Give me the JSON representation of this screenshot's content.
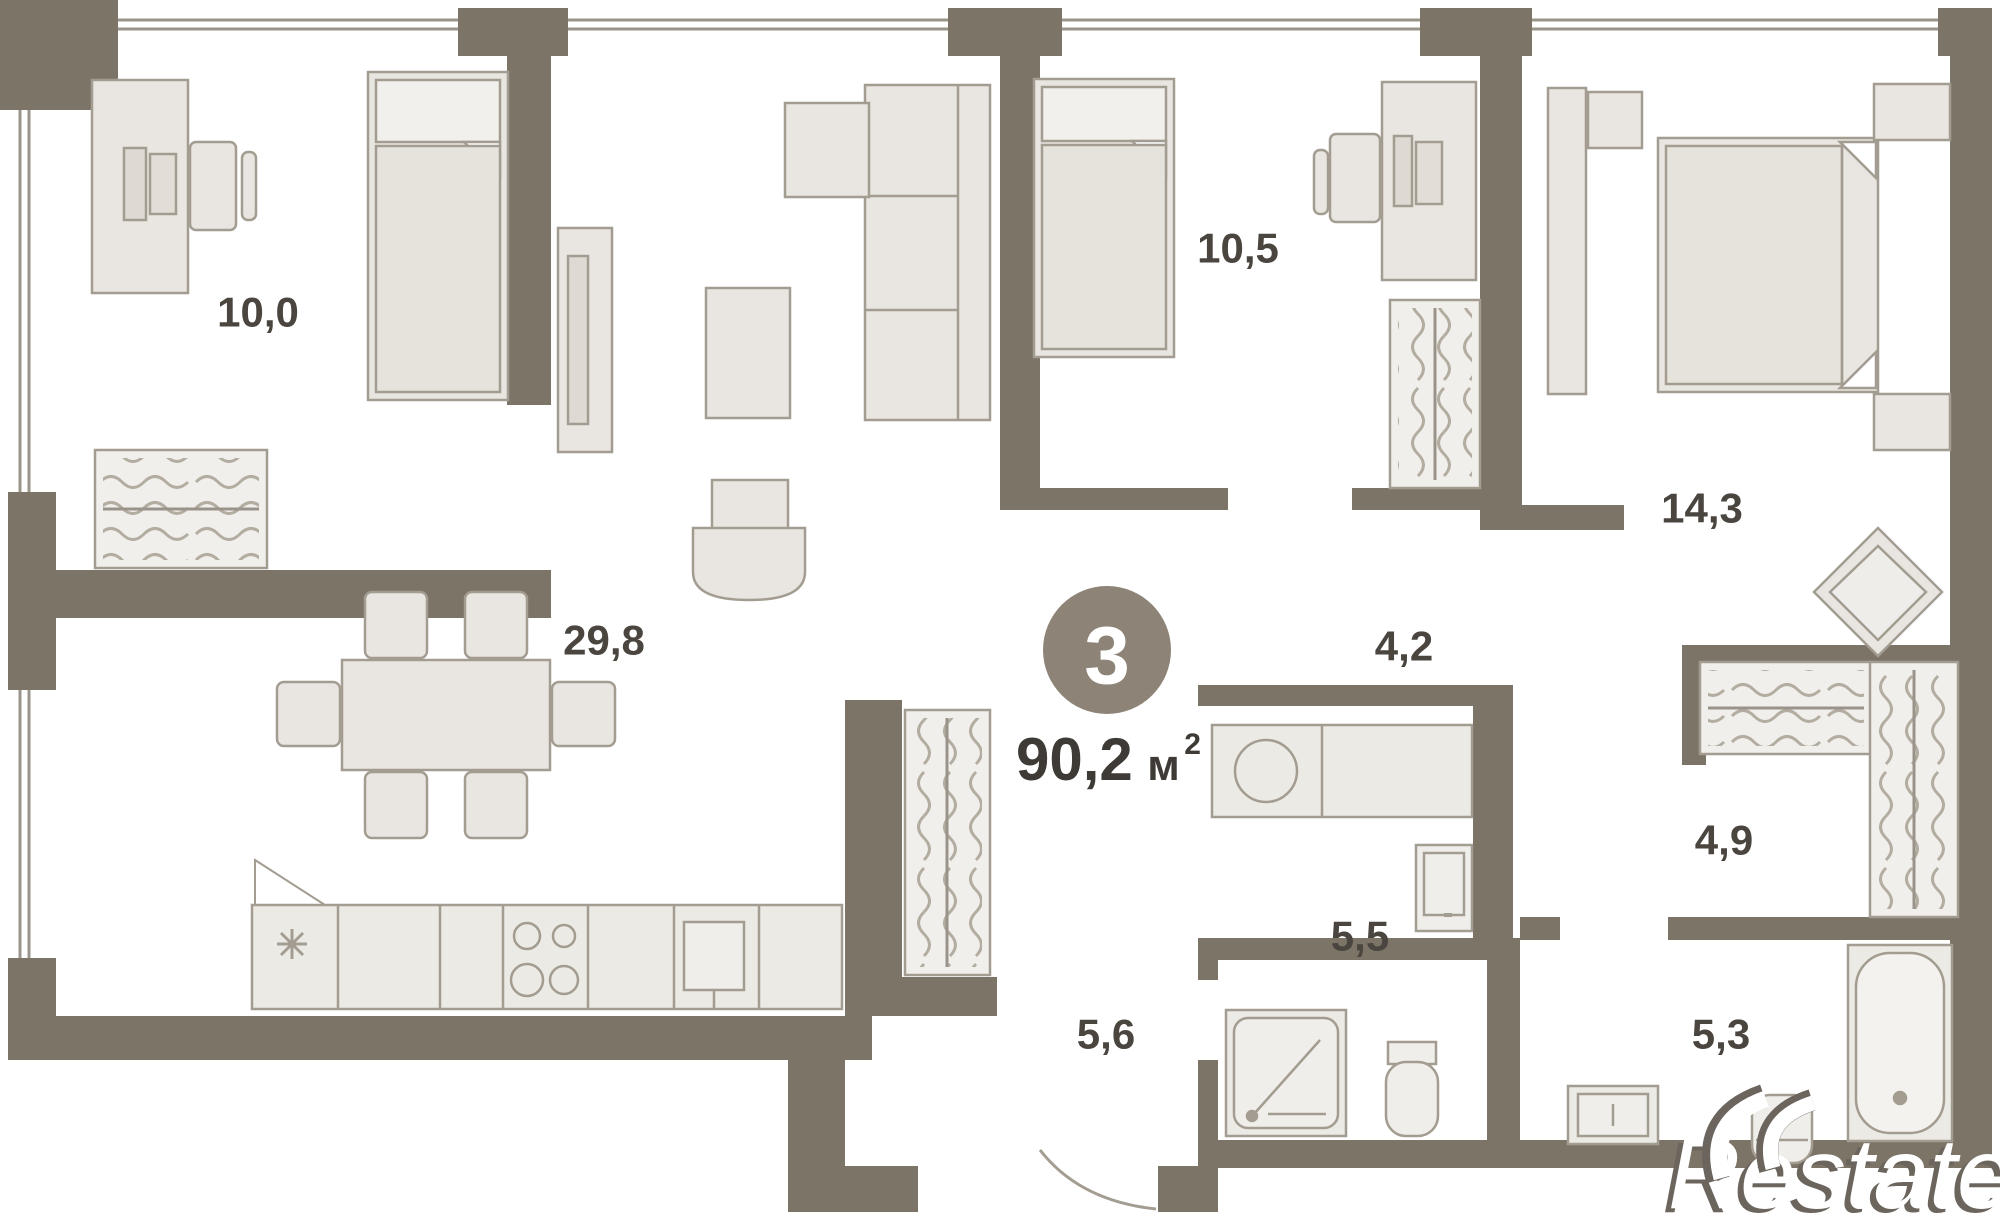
{
  "plan": {
    "badge": {
      "number": "3"
    },
    "total_area": {
      "value": "90,2",
      "unit": "м",
      "sup": "2"
    },
    "rooms": [
      {
        "id": "bedroom-left",
        "label": "10,0"
      },
      {
        "id": "living-kitchen",
        "label": "29,8"
      },
      {
        "id": "bedroom-mid",
        "label": "10,5"
      },
      {
        "id": "bedroom-right",
        "label": "14,3"
      },
      {
        "id": "hallway",
        "label": "4,2"
      },
      {
        "id": "laundry",
        "label": "5,5"
      },
      {
        "id": "entry-corridor",
        "label": "5,6"
      },
      {
        "id": "walkin-closet",
        "label": "4,9"
      },
      {
        "id": "bathroom",
        "label": "5,3"
      }
    ],
    "watermark": {
      "brand": "Restate"
    },
    "colors": {
      "wall": "#7d7468",
      "furniture_fill": "#e9e6e1",
      "furniture_stroke": "#a39c91",
      "label_text": "#4a463f",
      "badge_fill": "#8d8477",
      "badge_text": "#ffffff",
      "watermark_shadow": "#6b655e"
    }
  }
}
